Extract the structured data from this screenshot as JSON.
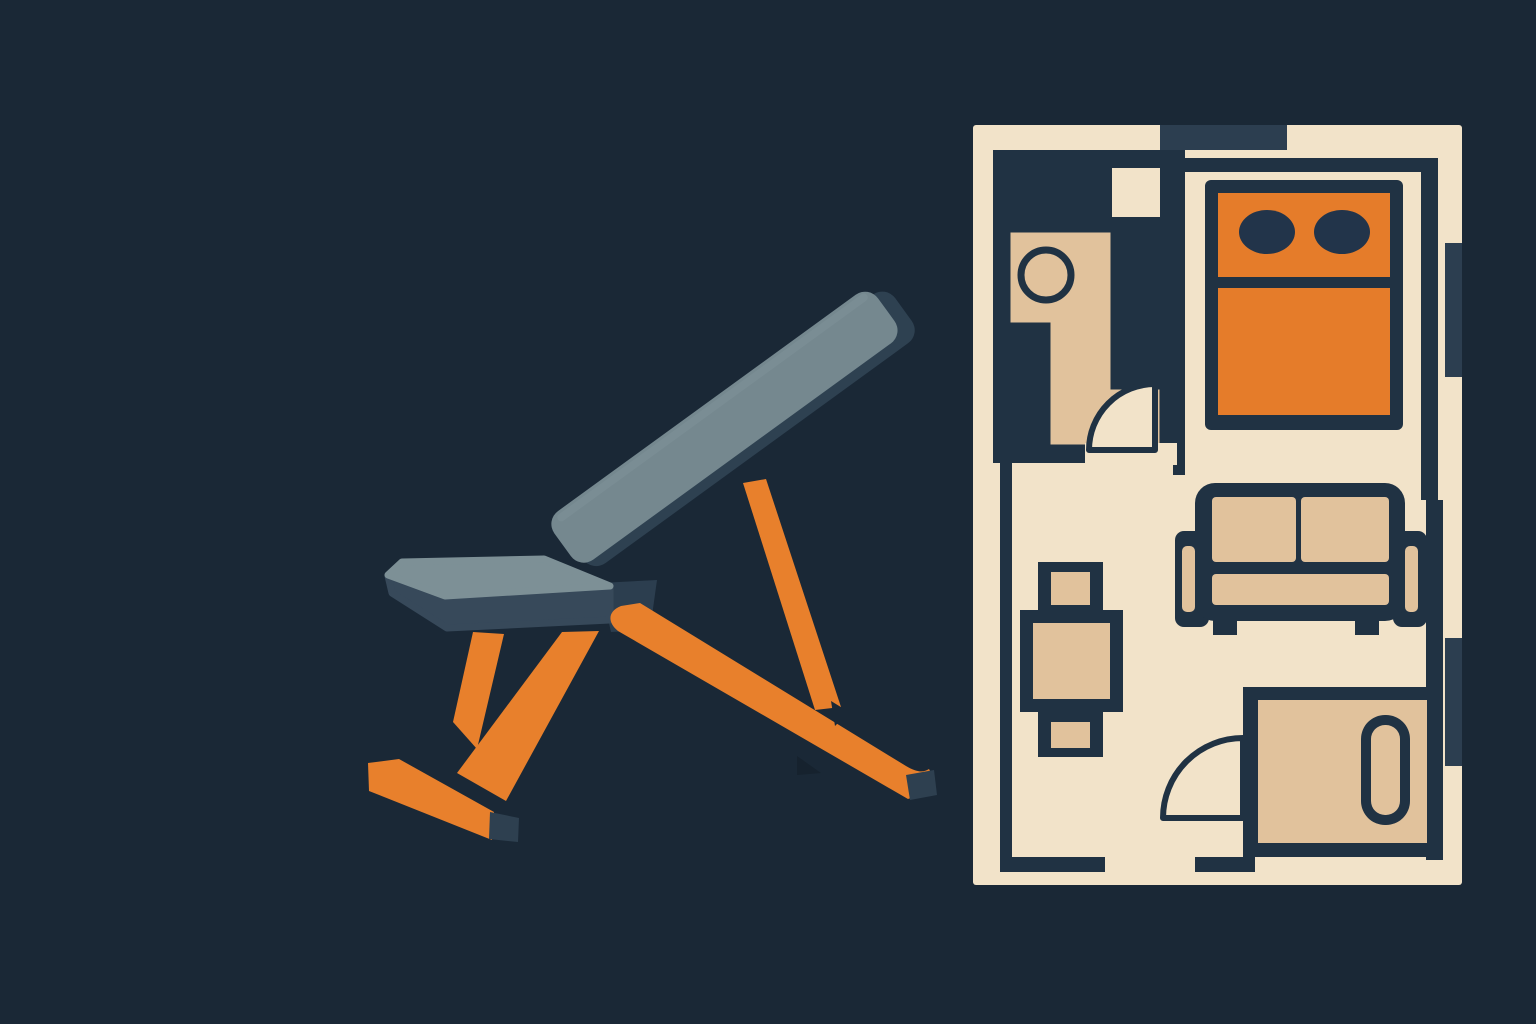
{
  "title": "Flat vector illustration of an adjustable weight bench beside a studio apartment floor plan",
  "palette": {
    "bg": "#1a2836",
    "pad": "#75888f",
    "pad-light": "#7d9096",
    "pad-dark": "#2e4151",
    "pad-side": "#37495a",
    "hinge": "#2c3e4f",
    "orange": "#e8802c",
    "cap": "#2e4050",
    "shadow": "#16222e",
    "plan-cream": "#f2e3c9",
    "plan-tan": "#e1c29c",
    "plan-orange": "#e57c2a",
    "wall": "#203243",
    "window": "#2c3e50",
    "pillow": "#22344a"
  },
  "scene": {
    "background": "dark navy",
    "left_subject": {
      "name": "adjustable incline weight bench",
      "back_pad_color_key": "pad",
      "seat_pad_color_key": "pad-light",
      "frame_color_key": "orange",
      "feet_cap_color_key": "cap"
    },
    "right_subject": {
      "name": "apartment floor plan",
      "floor_color_key": "plan-cream",
      "wall_color_key": "wall",
      "rooms": [
        {
          "name": "bathroom",
          "items": [
            "vanity-with-sink",
            "door-swing-arc",
            "window-square"
          ]
        },
        {
          "name": "bedroom",
          "items": [
            "double-bed-orange",
            "two-pillows"
          ]
        },
        {
          "name": "living-room",
          "items": [
            "sofa",
            "dining-table-with-two-chairs",
            "door-swing-arc"
          ]
        },
        {
          "name": "study",
          "items": [
            "desk-rug",
            "lounge-pill-chair"
          ]
        }
      ],
      "windows": [
        "top-edge",
        "right-edge-upper",
        "right-edge-lower"
      ]
    }
  }
}
